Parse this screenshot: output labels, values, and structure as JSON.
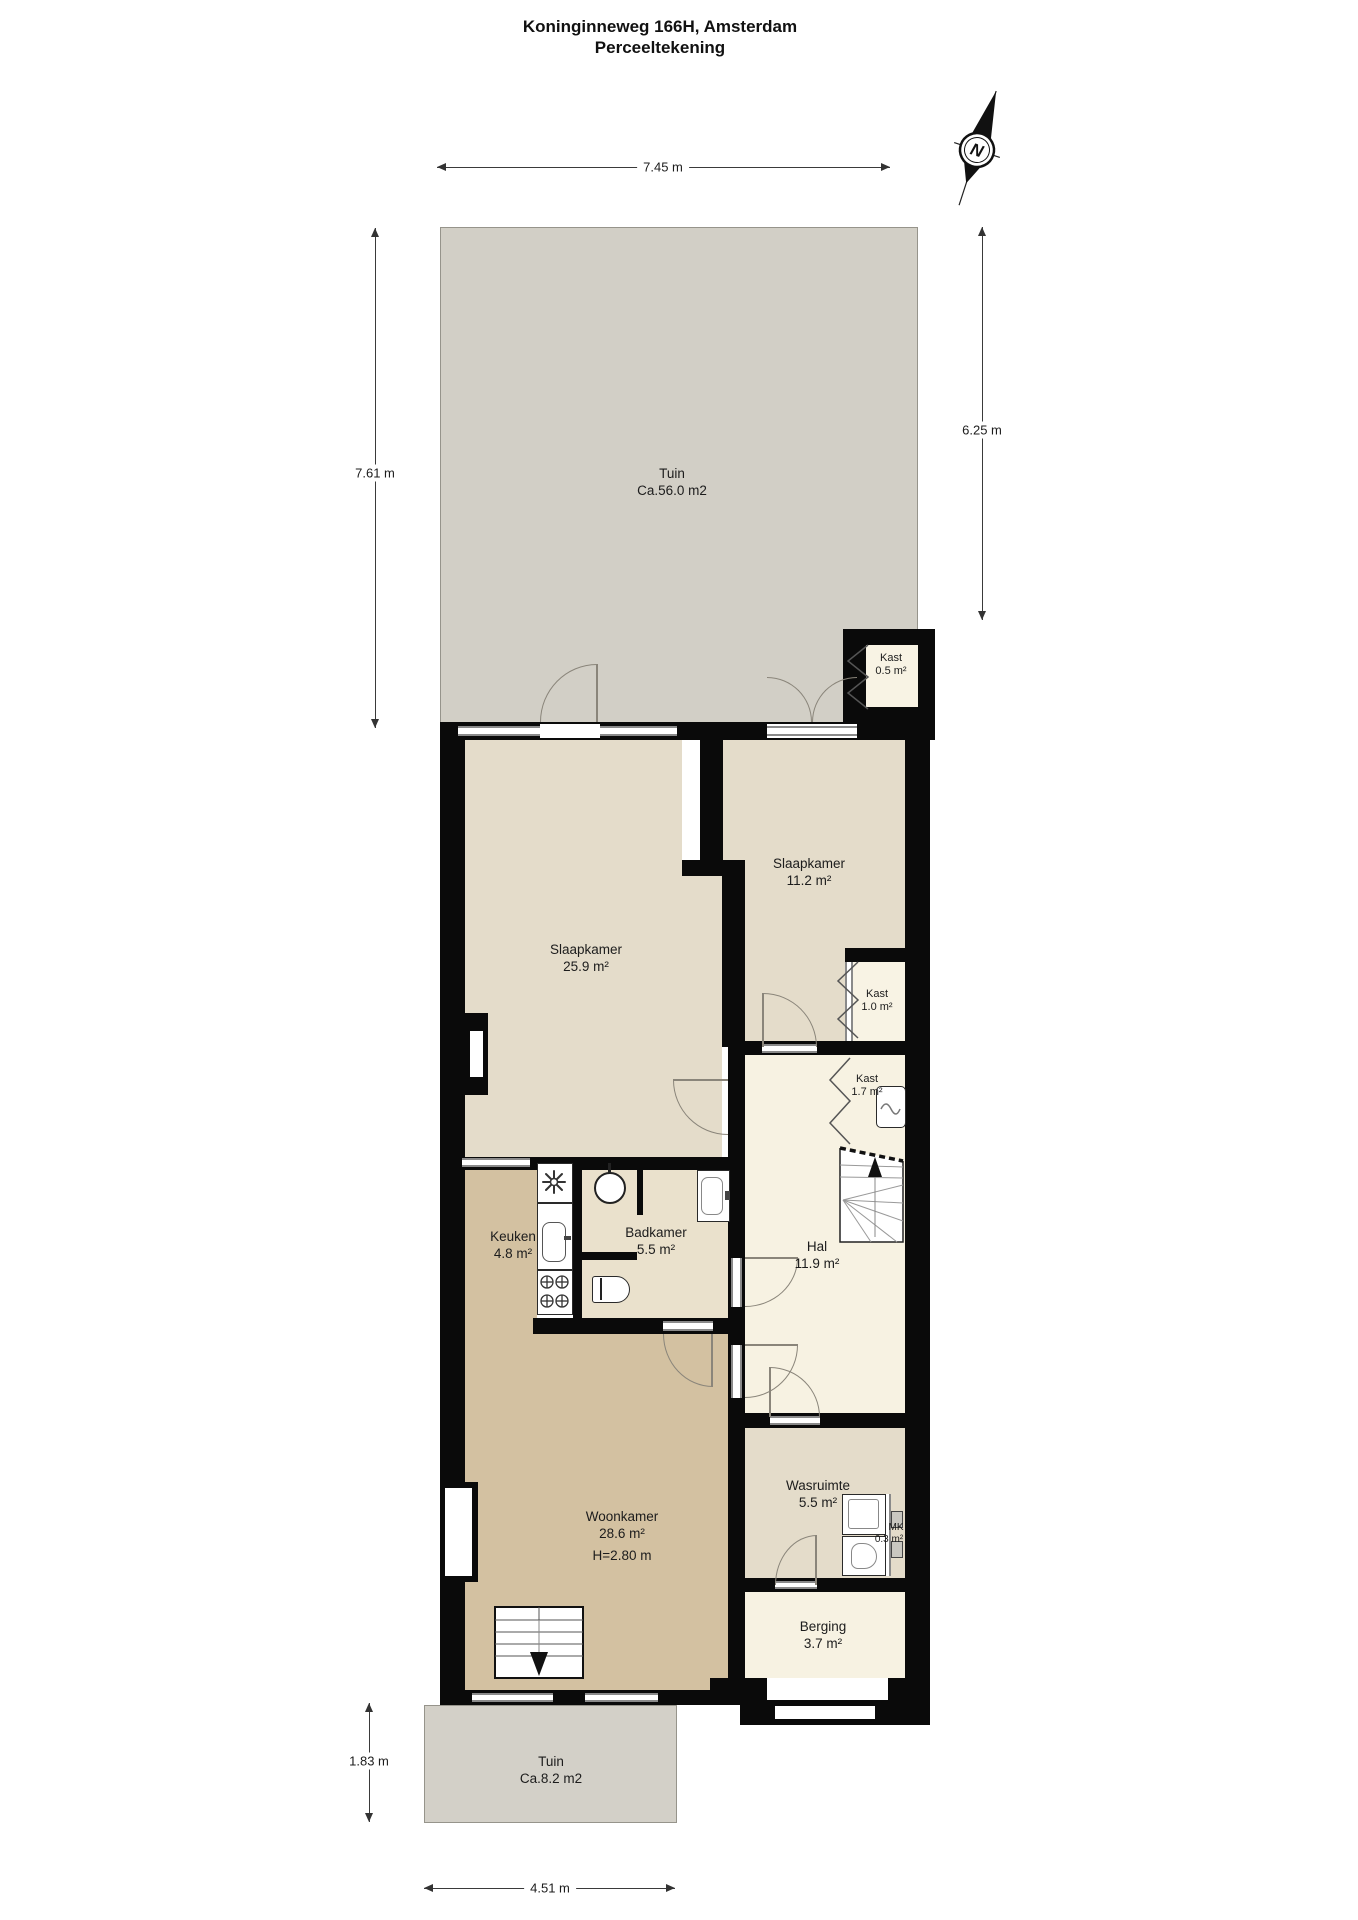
{
  "title": {
    "line1": "Koninginneweg 166H, Amsterdam",
    "line2": "Perceeltekening"
  },
  "compass": {
    "north_label": "N"
  },
  "dimensions": {
    "top": "7.45 m",
    "left_upper": "7.61 m",
    "right": "6.25 m",
    "left_lower": "1.83 m",
    "bottom": "4.51 m"
  },
  "rooms": {
    "tuin_top": {
      "name": "Tuin",
      "area": "Ca.56.0 m2"
    },
    "kast_05": {
      "name": "Kast",
      "area": "0.5 m²"
    },
    "slaapkamer1": {
      "name": "Slaapkamer",
      "area": "25.9 m²"
    },
    "slaapkamer2": {
      "name": "Slaapkamer",
      "area": "11.2 m²"
    },
    "kast_10": {
      "name": "Kast",
      "area": "1.0 m²"
    },
    "kast_17": {
      "name": "Kast",
      "area": "1.7 m²"
    },
    "badkamer": {
      "name": "Badkamer",
      "area": "5.5 m²"
    },
    "keuken": {
      "name": "Keuken",
      "area": "4.8 m²"
    },
    "hal": {
      "name": "Hal",
      "area": "11.9 m²"
    },
    "woonkamer": {
      "name": "Woonkamer",
      "area": "28.6 m²",
      "height": "H=2.80 m"
    },
    "wasruimte": {
      "name": "Wasruimte",
      "area": "5.5 m²"
    },
    "mk": {
      "name": "MK",
      "area": "0.3 m²"
    },
    "berging": {
      "name": "Berging",
      "area": "3.7 m²"
    },
    "tuin_bottom": {
      "name": "Tuin",
      "area": "Ca.8.2 m2"
    }
  },
  "colors": {
    "wall": "#0a0a0a",
    "garden": "#d2cfc6",
    "bedroom_beige": "#e4dcca",
    "bathroom_beige": "#eae1cc",
    "living_tan": "#d3c1a1",
    "hall_cream": "#f7f2e2",
    "door_arc": "#8a857a"
  }
}
